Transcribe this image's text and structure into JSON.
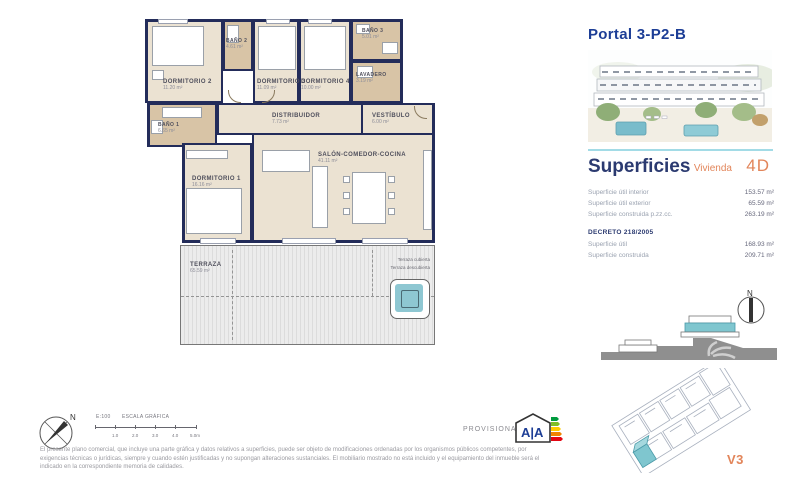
{
  "panel": {
    "title": "Portal 3-P2-B",
    "superficies": {
      "heading": "Superficies",
      "vivienda_label": "Vivienda",
      "vivienda_value": "4D",
      "rows": [
        {
          "label": "Superficie útil interior",
          "value": "153.57 m²"
        },
        {
          "label": "Superficie útil exterior",
          "value": "65.59 m²"
        },
        {
          "label": "Superficie construida p.zz.cc.",
          "value": "263.19 m²"
        }
      ],
      "decreto_heading": "DECRETO 218/2005",
      "decreto_rows": [
        {
          "label": "Superficie útil",
          "value": "168.93 m²"
        },
        {
          "label": "Superficie construida",
          "value": "209.71 m²"
        }
      ]
    },
    "version": "V3",
    "compass_north": "N"
  },
  "floorplan": {
    "rooms": [
      {
        "name": "DORMITORIO 2",
        "area": "11.20 m²"
      },
      {
        "name": "BAÑO 2",
        "area": "4.61 m²"
      },
      {
        "name": "DORMITORIO 3",
        "area": "11.09 m²"
      },
      {
        "name": "DORMITORIO 4",
        "area": "10.00 m²"
      },
      {
        "name": "BAÑO 3",
        "area": "5.01 m²"
      },
      {
        "name": "LAVADERO",
        "area": "3.19 m²"
      },
      {
        "name": "BAÑO 1",
        "area": "6.65 m²"
      },
      {
        "name": "DISTRIBUIDOR",
        "area": "7.73 m²"
      },
      {
        "name": "VESTÍBULO",
        "area": "6.00 m²"
      },
      {
        "name": "DORMITORIO 1",
        "area": "16.16 m²"
      },
      {
        "name": "SALÓN-COMEDOR-COCINA",
        "area": "41.11 m²"
      },
      {
        "name": "TERRAZA",
        "area": "65.59 m²"
      }
    ],
    "terraza_notes": [
      "Terraza cubierta",
      "Terraza descubierta"
    ]
  },
  "footer": {
    "scale_code": "E:100",
    "scale_title": "ESCALA GRÁFICA",
    "scale_ticks": [
      "1.0",
      "2.0",
      "3.0",
      "4.0",
      "5.0m"
    ],
    "compass_north": "N",
    "provisional_label": "PROVISIONAL",
    "energy_letters": "A|A",
    "disclaimer": "El presente plano comercial, que incluye una parte gráfica y datos relativos a superficies, puede ser objeto de modificaciones ordenadas por los organismos públicos competentes, por exigencias técnicas o jurídicas, siempre y cuando estén justificadas y no supongan alteraciones sustanciales. El mobiliario mostrado no está incluido y el equipamiento del inmueble será el indicado en la correspondiente memoria de calidades."
  },
  "colors": {
    "wall_navy": "#232c5a",
    "floor_beige": "#ebe2d2",
    "bath_tan": "#d8c4a6",
    "accent_orange": "#e2855a",
    "title_blue": "#1d3e96",
    "heading_navy": "#2b3a70",
    "highlight_teal": "#7fc6cf",
    "water_teal": "#8ec7d2"
  }
}
